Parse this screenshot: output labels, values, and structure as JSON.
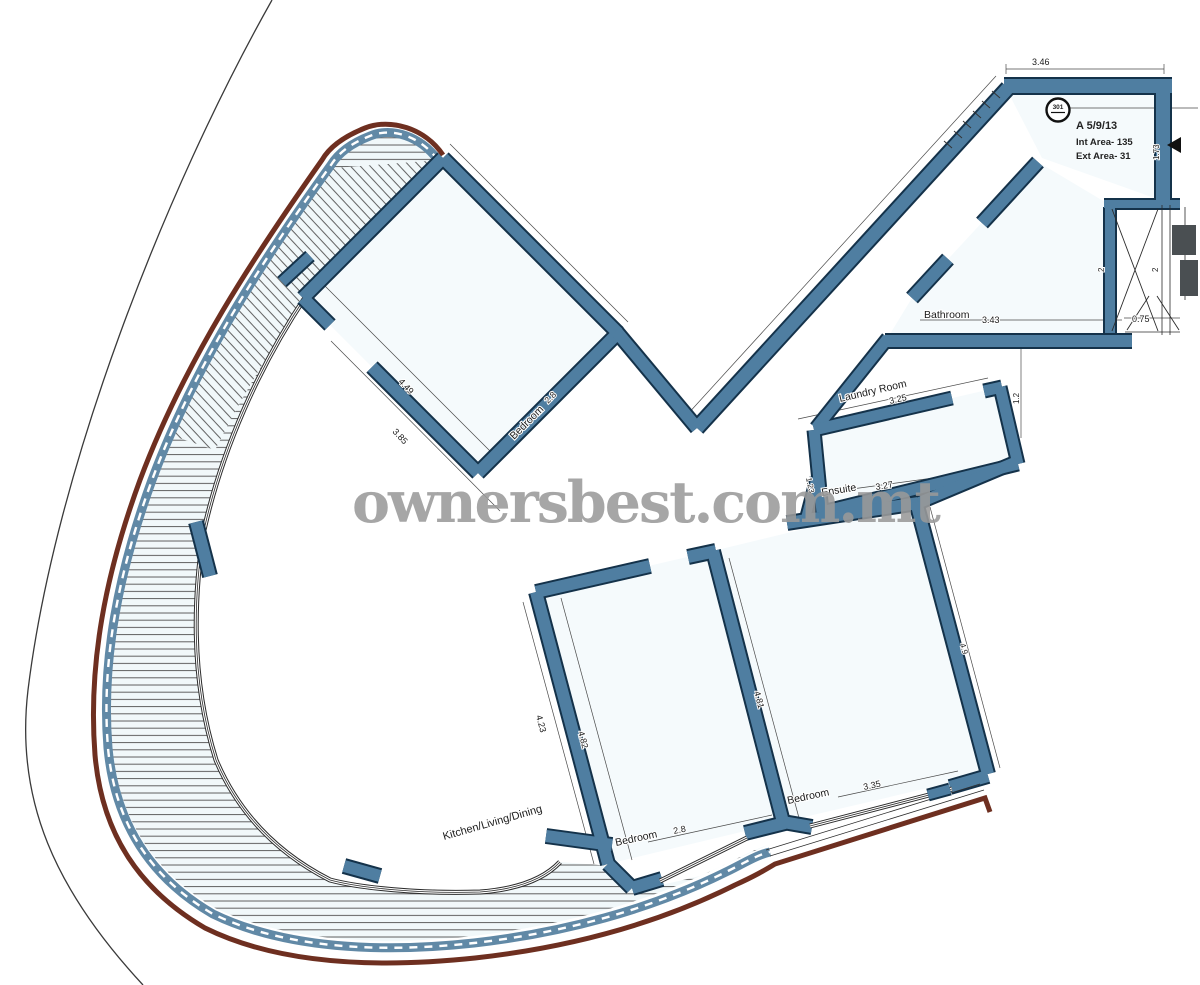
{
  "watermark": {
    "text": "ownersbest.com.mt",
    "color": "#9a9a9a"
  },
  "title_block": {
    "unit_ref": "A 5/9/13",
    "int_area": "Int Area- 135",
    "ext_area": "Ext Area- 31",
    "badge": "301"
  },
  "rooms": {
    "bedroom_top": {
      "label": "Bedroom",
      "width": "2.8",
      "dims": {
        "inner": "4.49",
        "outer": "3.85"
      }
    },
    "bathroom": {
      "label": "Bathroom",
      "width": "3.43"
    },
    "laundry": {
      "label": "Laundry Room",
      "width": "3.25"
    },
    "ensuite": {
      "label": "Ensuite",
      "width": "3.27",
      "depth": "1.23"
    },
    "bedroom_mid": {
      "label": "Bedroom",
      "width": "2.8",
      "dims": {
        "left": "4.23",
        "right": "4.82"
      }
    },
    "bedroom_right": {
      "label": "Bedroom",
      "width": "3.35",
      "dims": {
        "left": "4.81",
        "right": "4.9"
      }
    },
    "kitchen": {
      "label": "Kitchen/Living/Dining"
    }
  },
  "dimensions": {
    "top_wall": "3.46",
    "entry_door": "0.75",
    "entry_depth": "1.73",
    "shaft_left": "2",
    "shaft_right": "2",
    "hall_gap": "1.2"
  },
  "colors": {
    "wall": "#4f7ea1",
    "wall_outline": "#14324a",
    "terrace_edge": "#6e2f20",
    "railing": "#6189a6",
    "column": "#4a4f52"
  }
}
